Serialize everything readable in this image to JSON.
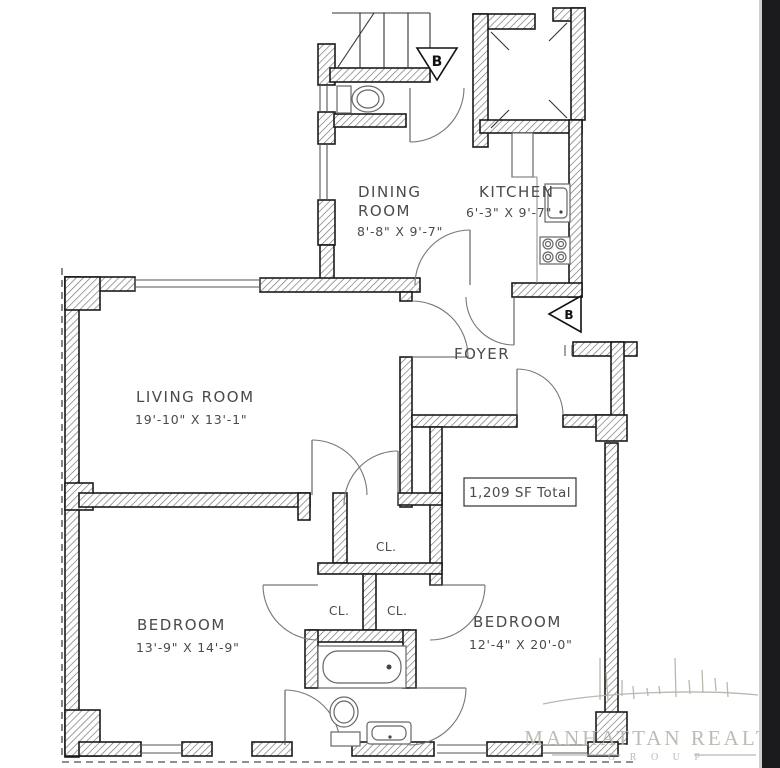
{
  "plan": {
    "rooms": {
      "dining": {
        "name_line1": "DINING",
        "name_line2": "ROOM",
        "dims": "8'-8\" X 9'-7\""
      },
      "kitchen": {
        "name": "KITCHEN",
        "dims": "6'-3\" X 9'-7\""
      },
      "living": {
        "name": "LIVING ROOM",
        "dims": "19'-10\" X 13'-1\""
      },
      "foyer": {
        "name": "FOYER"
      },
      "bedroom_left": {
        "name": "BEDROOM",
        "dims": "13'-9\" X 14'-9\""
      },
      "bedroom_right": {
        "name": "BEDROOM",
        "dims": "12'-4\" X 20'-0\""
      },
      "closet_upper": {
        "name": "CL."
      },
      "closet_left": {
        "name": "CL."
      },
      "closet_right": {
        "name": "CL."
      }
    },
    "total_area_label": "1,209 SF Total",
    "section_markers": {
      "marker_top": "B",
      "marker_side": "B"
    },
    "colors": {
      "wall_outline": "#1a1a1a",
      "hatch_line": "#6e6e6e",
      "label_text": "#4a4a4a",
      "watermark": "#b7b4ab",
      "right_strip": "#1b1b1d"
    }
  },
  "watermark": {
    "line1": "MANHATTAN REALTY",
    "line2": "G R O U P"
  }
}
